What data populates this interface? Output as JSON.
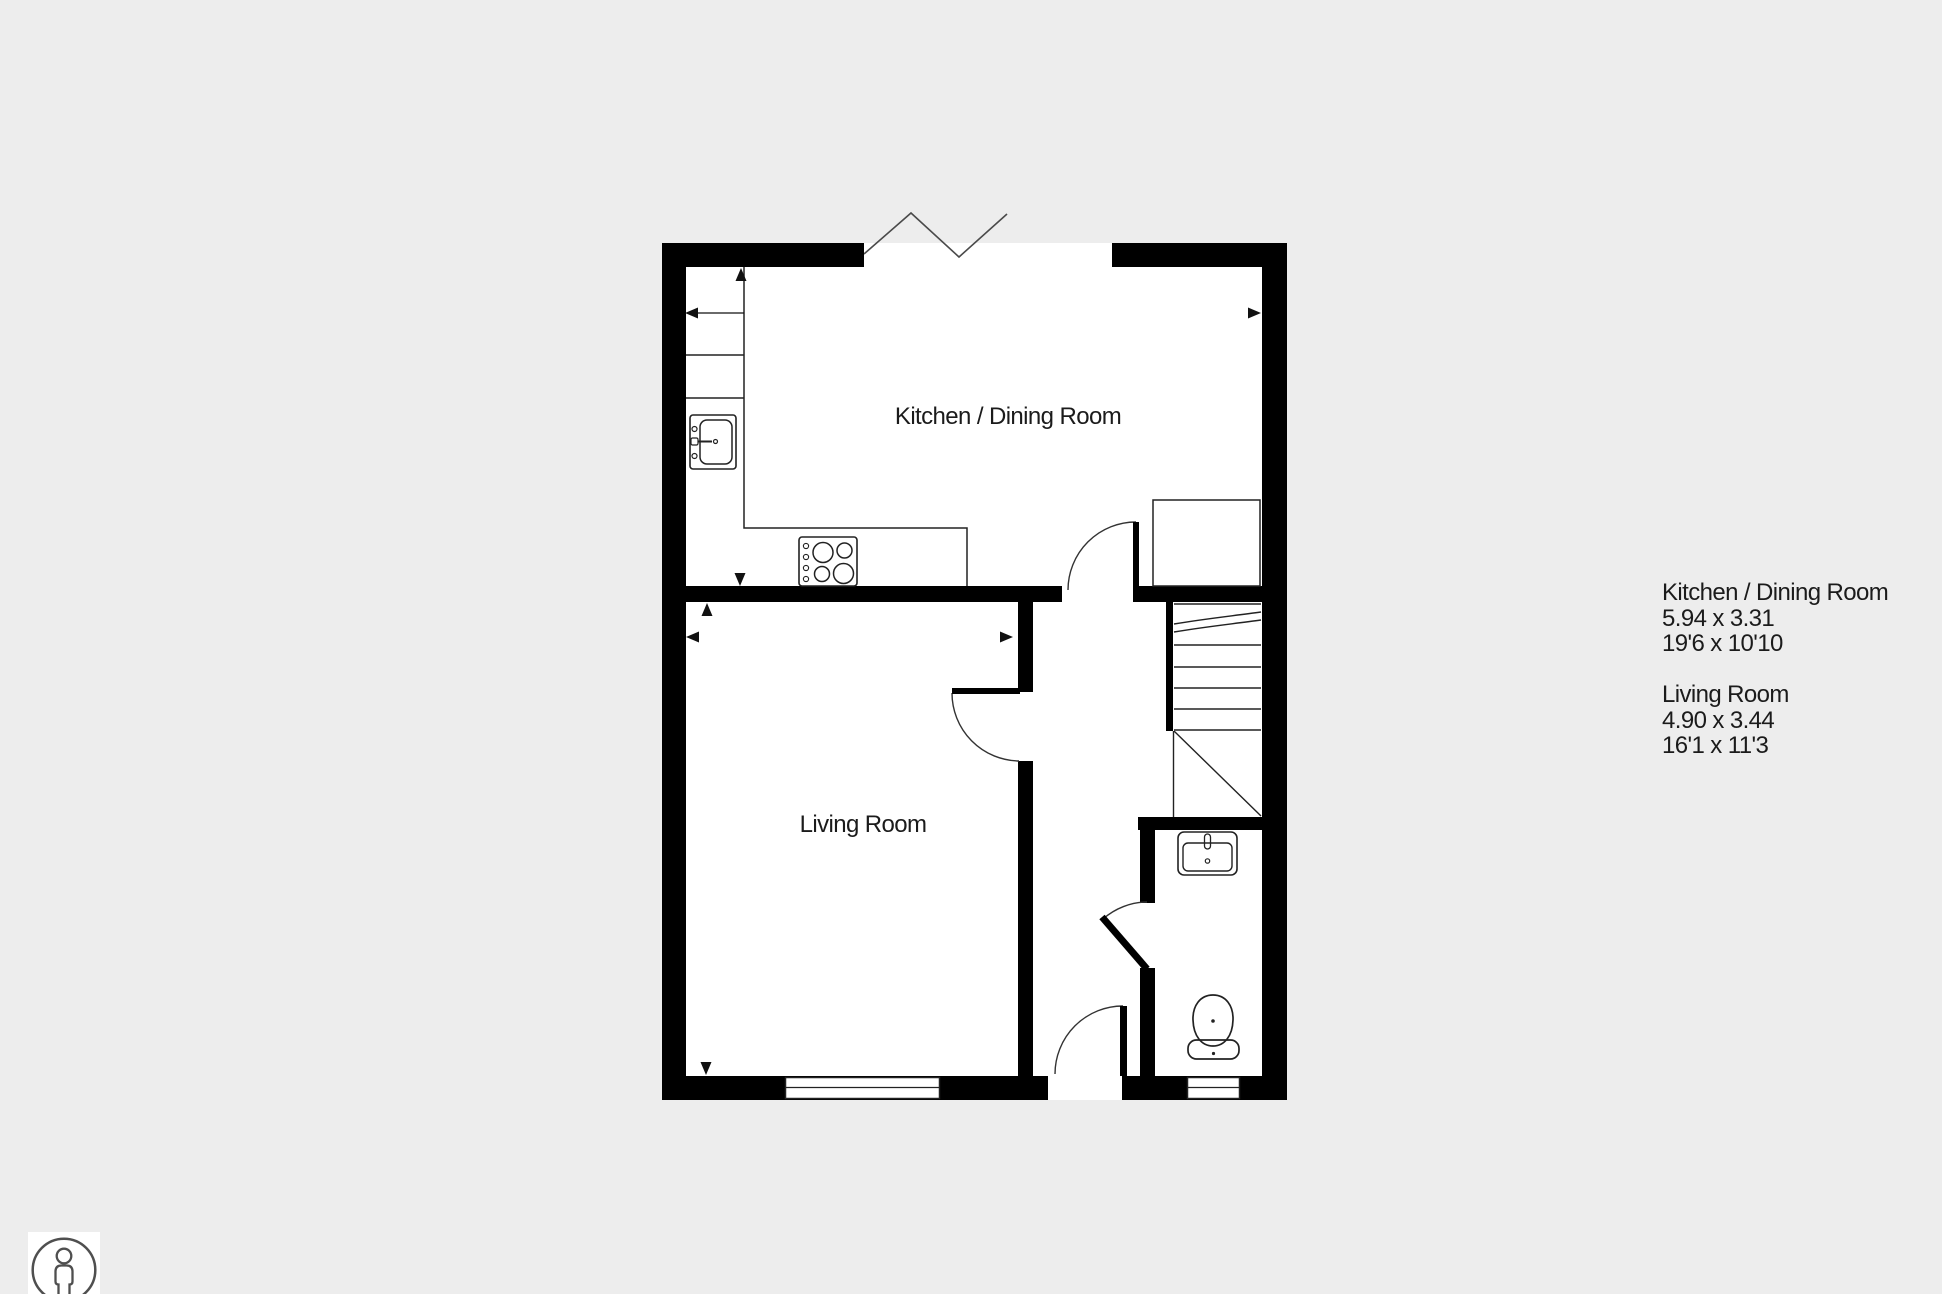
{
  "page": {
    "background_color": "#ededed"
  },
  "plan": {
    "floor_color": "#ffffff",
    "wall_color": "#000000",
    "detail_line_color": "#222222",
    "room_labels": {
      "kitchen": "Kitchen / Dining Room",
      "living_room": "Living Room"
    },
    "fixture_icons": [
      "kitchen-sink-icon",
      "hob-icon",
      "staircase-icon",
      "built-in-cupboard-icon",
      "basin-icon",
      "toilet-icon",
      "window-icon",
      "door-swing-icon",
      "wall-break-zigzag-icon",
      "dimension-arrow-icon"
    ]
  },
  "info_panel": {
    "text_color": "#1b1b1b",
    "rooms": [
      {
        "name": "Kitchen / Dining Room",
        "size_metric": "5.94 x 3.31",
        "size_imperial": "19'6 x 10'10"
      },
      {
        "name": "Living Room",
        "size_metric": "4.90 x 3.44",
        "size_imperial": "16'1 x 11'3"
      }
    ]
  },
  "branding": {
    "person_badge_icon": "person-in-circle-icon"
  }
}
